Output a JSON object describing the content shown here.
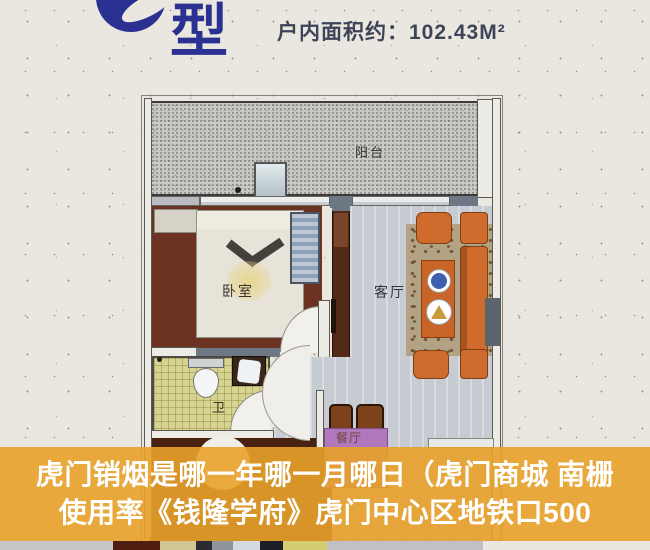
{
  "header": {
    "unit_type_suffix": "型",
    "area_text": "户内面积约：102.43M²"
  },
  "floorplan": {
    "labels": {
      "balcony": "阳台",
      "bedroom": "卧室",
      "living_room": "客厅",
      "bathroom": "卫",
      "dining_room": "餐厅"
    }
  },
  "overlay": {
    "line1": "虎门销烟是哪一年哪一月哪日（虎门商城 南栅",
    "line2": "使用率《钱隆学府》虎门中心区地铁口500"
  },
  "colors": {
    "logo_blue": "#2B3190",
    "header_text": "#3E4457",
    "overlay_orange": "#E8A12A",
    "overlay_text": "#FFFFFF"
  }
}
